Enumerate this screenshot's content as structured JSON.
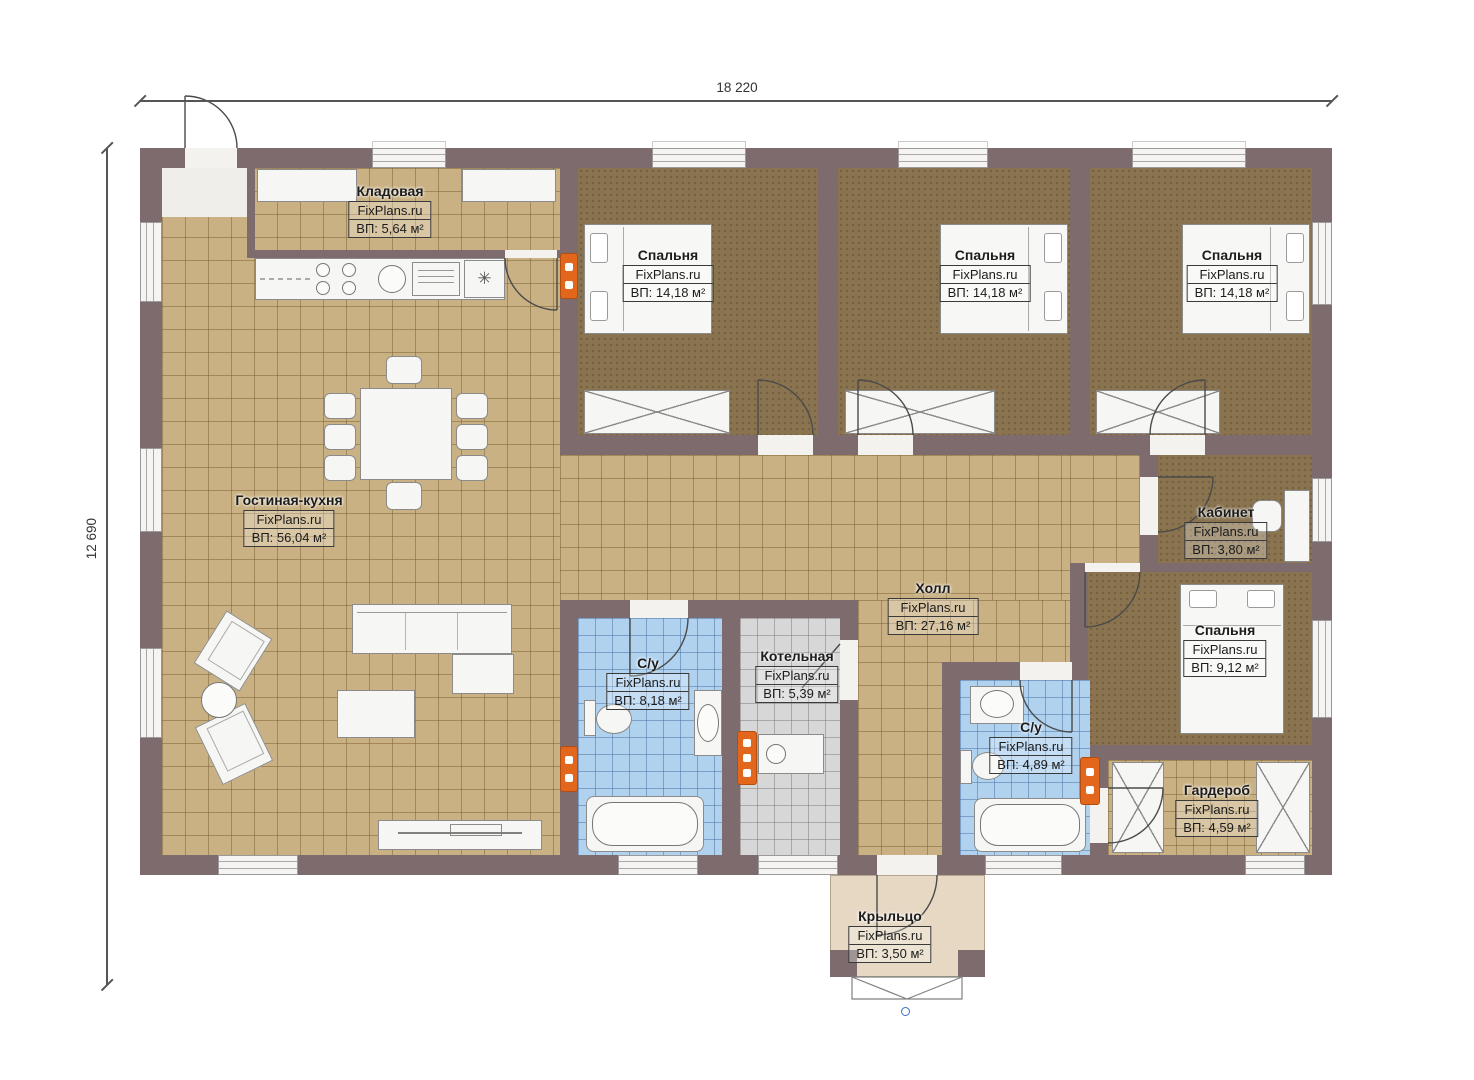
{
  "dimensions": {
    "width_label": "18 220",
    "height_label": "12 690"
  },
  "rooms": [
    {
      "id": "kladovaya",
      "name": "Кладовая",
      "brand": "FixPlans.ru",
      "area": "ВП: 5,64 м²"
    },
    {
      "id": "bedroom1",
      "name": "Спальня",
      "brand": "FixPlans.ru",
      "area": "ВП: 14,18 м²"
    },
    {
      "id": "bedroom2",
      "name": "Спальня",
      "brand": "FixPlans.ru",
      "area": "ВП: 14,18 м²"
    },
    {
      "id": "bedroom3",
      "name": "Спальня",
      "brand": "FixPlans.ru",
      "area": "ВП: 14,18 м²"
    },
    {
      "id": "living",
      "name": "Гостиная-кухня",
      "brand": "FixPlans.ru",
      "area": "ВП: 56,04 м²"
    },
    {
      "id": "kabinet",
      "name": "Кабинет",
      "brand": "FixPlans.ru",
      "area": "ВП: 3,80 м²"
    },
    {
      "id": "hall",
      "name": "Холл",
      "brand": "FixPlans.ru",
      "area": "ВП: 27,16 м²"
    },
    {
      "id": "bathroom1",
      "name": "С/у",
      "brand": "FixPlans.ru",
      "area": "ВП: 8,18 м²"
    },
    {
      "id": "boiler",
      "name": "Котельная",
      "brand": "FixPlans.ru",
      "area": "ВП: 5,39 м²"
    },
    {
      "id": "bathroom2",
      "name": "С/у",
      "brand": "FixPlans.ru",
      "area": "ВП: 4,89 м²"
    },
    {
      "id": "bedroom4",
      "name": "Спальня",
      "brand": "FixPlans.ru",
      "area": "ВП: 9,12 м²"
    },
    {
      "id": "garderob",
      "name": "Гардероб",
      "brand": "FixPlans.ru",
      "area": "ВП: 4,59 м²"
    },
    {
      "id": "porch",
      "name": "Крыльцо",
      "brand": "FixPlans.ru",
      "area": "ВП: 3,50 м²"
    }
  ],
  "icons": {
    "freezer": "✳"
  },
  "colors": {
    "wall": "#7d6b6d",
    "tile_floor": "#c9b183",
    "bedroom_floor": "#8a7450",
    "bath_tile": "#b0d2ef",
    "boiler_tile": "#d7d7d7",
    "porch_floor": "#e6d8c3",
    "radiator": "#e2661c",
    "accent_dot": "#3a6fc4"
  }
}
